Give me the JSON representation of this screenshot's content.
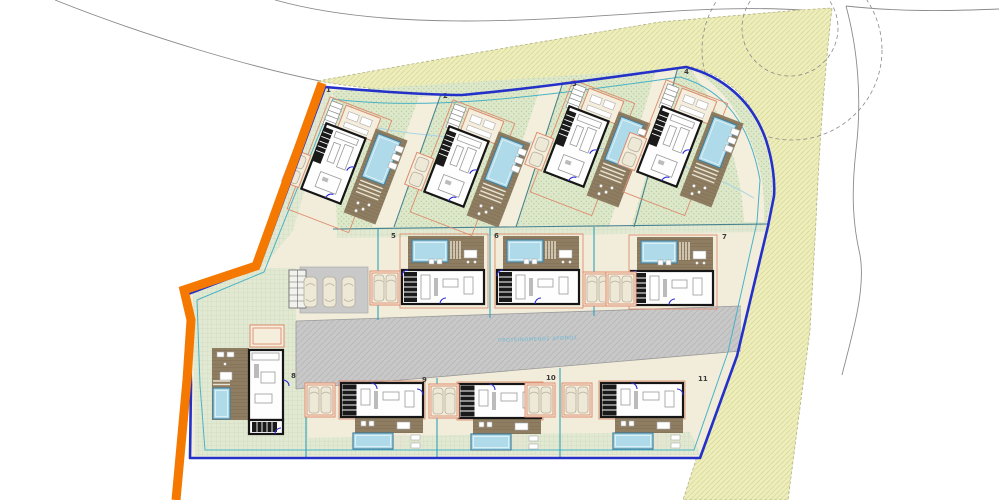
{
  "drawing": {
    "title": "villa development site plan",
    "road_label": "ΠΡΟΤΕΙΝΟΜΕΝΟΣ ΔΡΟΜΟΣ",
    "plots": [
      {
        "number": "1",
        "villa": "top",
        "x": 340,
        "y": 166,
        "rot": 21,
        "label_x": 326,
        "label_y": 92
      },
      {
        "number": "2",
        "villa": "top",
        "x": 463,
        "y": 169,
        "rot": 21,
        "label_x": 443,
        "label_y": 98
      },
      {
        "number": "3",
        "villa": "top",
        "x": 583,
        "y": 149,
        "rot": 21,
        "label_x": 572,
        "label_y": 86
      },
      {
        "number": "4",
        "villa": "top",
        "x": 676,
        "y": 149,
        "rot": 21,
        "label_x": 684,
        "label_y": 74
      },
      {
        "number": "5",
        "villa": "mid",
        "x": 402,
        "y": 270,
        "rot": 0,
        "label_x": 391,
        "label_y": 238
      },
      {
        "number": "6",
        "villa": "mid",
        "x": 497,
        "y": 270,
        "rot": 0,
        "label_x": 494,
        "label_y": 238
      },
      {
        "number": "7",
        "villa": "mid",
        "x": 631,
        "y": 271,
        "rot": 0,
        "label_x": 722,
        "label_y": 239
      },
      {
        "number": "8",
        "villa": "left",
        "x": 249,
        "y": 350,
        "rot": 0,
        "label_x": 291,
        "label_y": 378
      },
      {
        "number": "9",
        "villa": "bottom",
        "x": 341,
        "y": 383,
        "rot": 0,
        "label_x": 422,
        "label_y": 382
      },
      {
        "number": "10",
        "villa": "bottom",
        "x": 459,
        "y": 384,
        "rot": 0,
        "label_x": 546,
        "label_y": 380
      },
      {
        "number": "11",
        "villa": "bottom",
        "x": 601,
        "y": 383,
        "rot": 0,
        "label_x": 698,
        "label_y": 381
      }
    ],
    "parking_bays": [
      {
        "x": 370,
        "y": 271
      },
      {
        "x": 583,
        "y": 272
      },
      {
        "x": 606,
        "y": 272
      },
      {
        "x": 305,
        "y": 383
      },
      {
        "x": 429,
        "y": 384
      },
      {
        "x": 525,
        "y": 383
      },
      {
        "x": 562,
        "y": 383
      }
    ],
    "guest_cars": [
      {
        "x": 304,
        "y": 277
      },
      {
        "x": 323,
        "y": 277
      },
      {
        "x": 342,
        "y": 277
      }
    ],
    "colors": {
      "boundary_orange": "#f57900",
      "boundary_blue": "#2431c8",
      "setback_cyan": "#49b2c6",
      "contour_light_blue": "#a9d4e6",
      "khaki_area": "#ededbd",
      "road_gray": "#c9c9c9",
      "site_cream": "#f2edda",
      "garden_green": "#e2e9d2",
      "deck_brown": "#8e7d61",
      "pool_blue": "#aedae9",
      "red_outline": "#dd8c6e",
      "house_wall": "#161616"
    }
  }
}
